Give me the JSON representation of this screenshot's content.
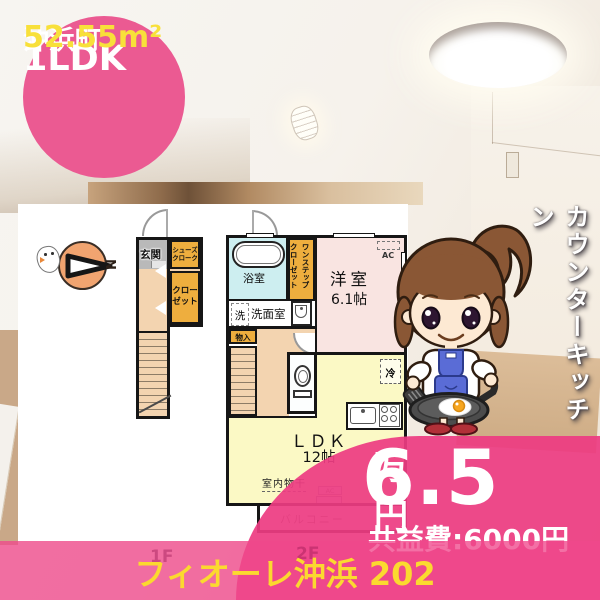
{
  "badge": {
    "layout_type": "1LDK",
    "location": "沖浜町",
    "area": "52.55m²"
  },
  "feature": {
    "vertical_text": "カウンターキッチン"
  },
  "price": {
    "rent_value": "6.5",
    "rent_unit": "万円",
    "common_fee": "共益費:6000円"
  },
  "footer": {
    "building_name": "フィオーレ沖浜 202",
    "floor_label_1f": "1F",
    "floor_label_2f": "2F"
  },
  "floorplan": {
    "compass_label": "N",
    "rooms": {
      "genkan": "玄関",
      "shoes_cloak_line1": "シューズ",
      "shoes_cloak_line2": "クローク",
      "closet_line1": "クロー",
      "closet_line2": "ゼット",
      "bathroom": "浴室",
      "one_step_closet_line1": "ワンステップ",
      "one_step_closet_line2": "クローゼット",
      "western_room": "洋室",
      "western_room_size": "6.1帖",
      "ac": "AC",
      "washer": "洗",
      "washroom": "洗面室",
      "storage": "物入",
      "fridge": "冷",
      "ldk": "ＬＤＫ",
      "ldk_size": "12帖",
      "indoor_drying": "室内物干",
      "balcony_ac": "AC",
      "balcony": "バルコニー"
    }
  },
  "colors": {
    "accent_pink": "#ec4a87",
    "band_pink": "#f4709e",
    "badge_yellow": "#f8e03a",
    "footer_yellow": "#fbd92f"
  }
}
